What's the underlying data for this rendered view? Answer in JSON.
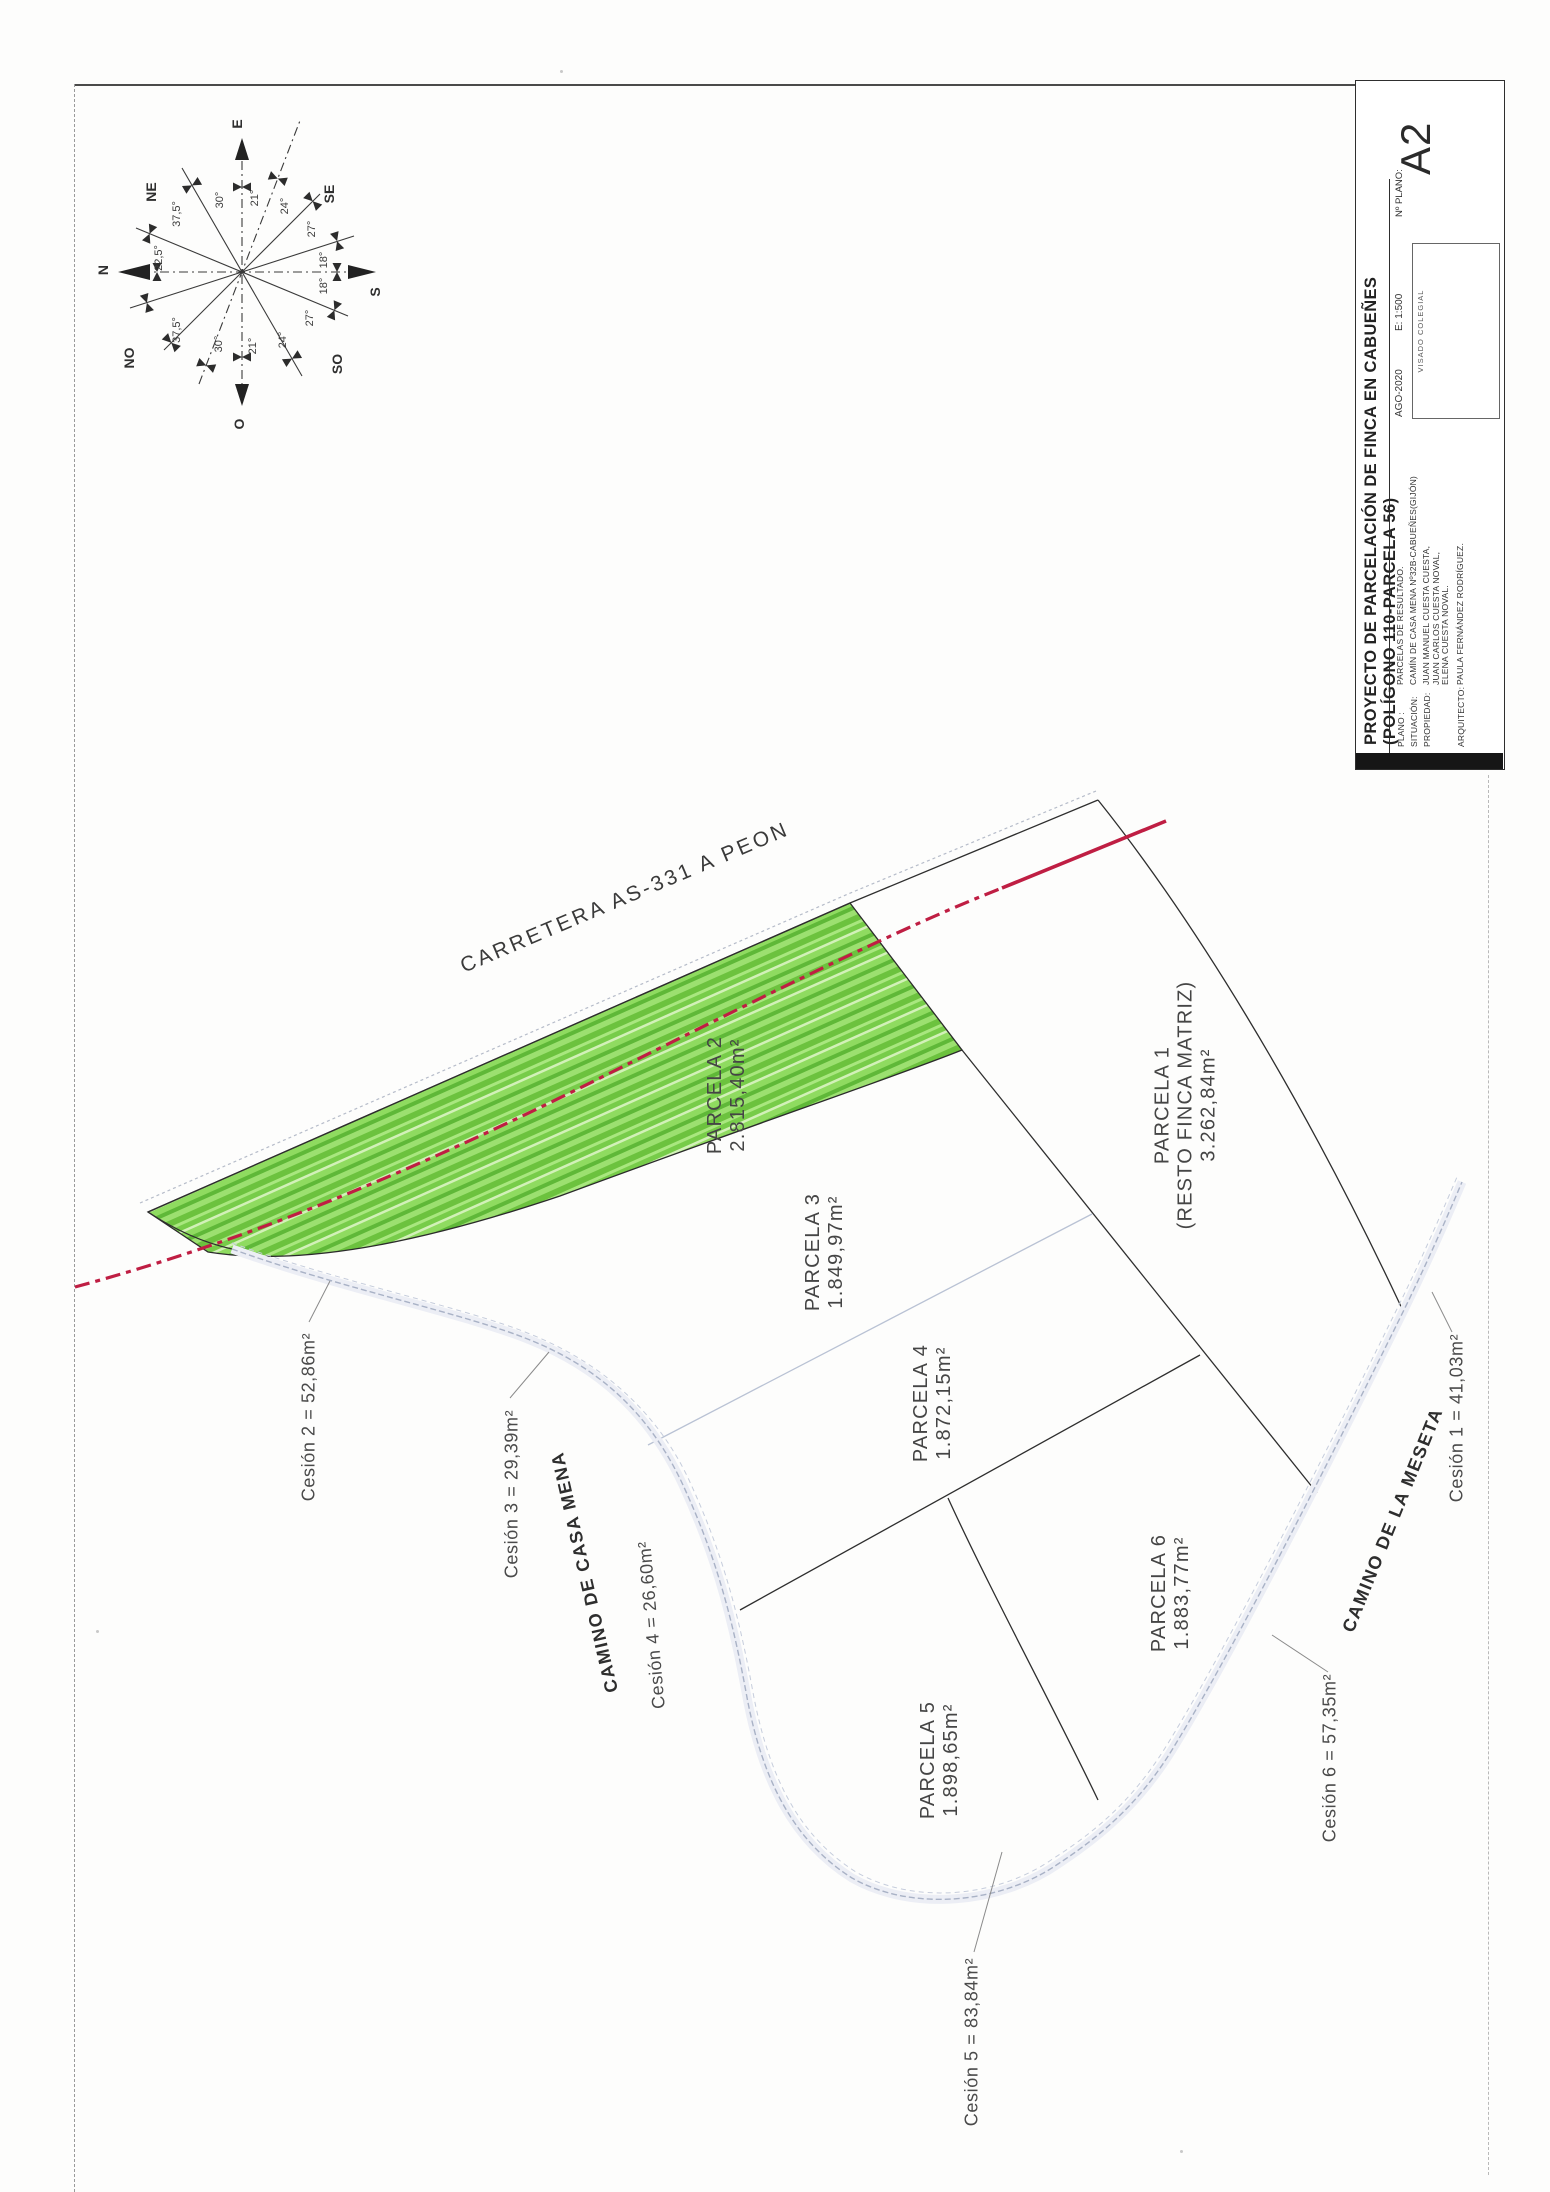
{
  "sheet": {
    "title": "PROYECTO DE PARCELACIÓN DE FINCA EN CABUEÑES (POLÍGONO 110-PARCELA 56)",
    "sheet_number": "A2",
    "plan_no_label": "Nº PLANO:",
    "date": "AGO-2020",
    "scale": "E: 1:500",
    "stamp": "VISADO COLEGIAL",
    "fields": [
      {
        "label": "PLANO :",
        "value": "PARCELAS DE RESULTADO."
      },
      {
        "label": "SITUACIÓN:",
        "value": "CAMÍN DE CASA MENA Nº32B-CABUEÑES(GIJÓN)"
      },
      {
        "label": "PROPIEDAD:",
        "value": "JUAN MANUEL CUESTA CUESTA, JUAN CARLOS CUESTA NOVAL, ELENA CUESTA NOVAL."
      },
      {
        "label": "ARQUITECTO:",
        "value": "PAULA FERNÁNDEZ RODRÍGUEZ."
      }
    ]
  },
  "map": {
    "highway_label": "CARRETERA AS-331 A PEON",
    "road_labels": [
      "CAMINO DE CASA MENA",
      "CAMINO DE LA MESETA"
    ],
    "parcels": [
      {
        "name": "PARCELA 1",
        "sub": "(RESTO FINCA MATRIZ)",
        "area": "3.262,84m²"
      },
      {
        "name": "PARCELA 2",
        "area": "2.815,40m²"
      },
      {
        "name": "PARCELA 3",
        "area": "1.849,97m²"
      },
      {
        "name": "PARCELA 4",
        "area": "1.872,15m²"
      },
      {
        "name": "PARCELA 5",
        "area": "1.898,65m²"
      },
      {
        "name": "PARCELA 6",
        "area": "1.883,77m²"
      }
    ],
    "cessions": [
      {
        "label": "Cesión 1 = 41,03m²"
      },
      {
        "label": "Cesión 2 = 52,86m²"
      },
      {
        "label": "Cesión 3 = 29,39m²"
      },
      {
        "label": "Cesión 4 = 26,60m²"
      },
      {
        "label": "Cesión 5 = 83,84m²"
      },
      {
        "label": "Cesión 6 = 57,35m²"
      }
    ],
    "colors": {
      "highlight_green": "#7fd24f",
      "axis_red": "#c01f45",
      "road_gray": "#a9b2c6"
    }
  },
  "compass": {
    "points": [
      "E",
      "S",
      "O",
      "N",
      "NE",
      "SE",
      "NO",
      "SO"
    ],
    "angles": [
      "30°",
      "21°",
      "24°",
      "27°",
      "18°",
      "18°",
      "27°",
      "24°",
      "21°",
      "30°",
      "37,5°",
      "22,5°",
      "37,5°"
    ]
  }
}
